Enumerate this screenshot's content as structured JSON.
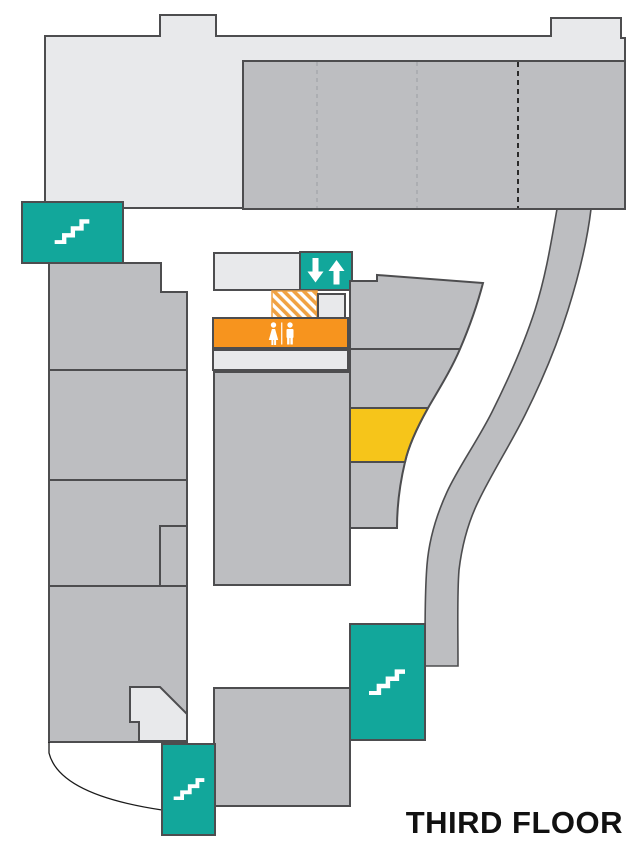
{
  "title": "THIRD FLOOR",
  "colors": {
    "teal": "#12A79B",
    "orange": "#F7941E",
    "yellow": "#F6C51A",
    "light_gray": "#E8E9EB",
    "mid_gray": "#BDBEC1",
    "outline": "#4D4D4F",
    "hatch_orange": "#F0A243",
    "dash_light": "#A6A8AB",
    "dash_dark": "#1A1A1A",
    "text": "#111111",
    "white": "#FFFFFF"
  },
  "features": [
    {
      "name": "stairs-top-left",
      "type": "stairs",
      "icon": "stairs-icon",
      "color": "#12A79B"
    },
    {
      "name": "stairs-bottom-right",
      "type": "stairs",
      "icon": "stairs-icon",
      "color": "#12A79B"
    },
    {
      "name": "stairs-bottom-left",
      "type": "stairs",
      "icon": "stairs-icon",
      "color": "#12A79B"
    },
    {
      "name": "elevator",
      "type": "elevator",
      "icon": "up-down-arrows-icon",
      "color": "#12A79B"
    },
    {
      "name": "restrooms",
      "type": "restroom",
      "icon": "female-male-figures-icon",
      "color": "#F7941E"
    },
    {
      "name": "highlighted-room",
      "type": "highlight",
      "color": "#F6C51A"
    },
    {
      "name": "hatched-area",
      "type": "hatched-area",
      "color": "#F0A243"
    },
    {
      "name": "curved-corridor",
      "type": "corridor",
      "color": "#BDBEC1"
    }
  ]
}
